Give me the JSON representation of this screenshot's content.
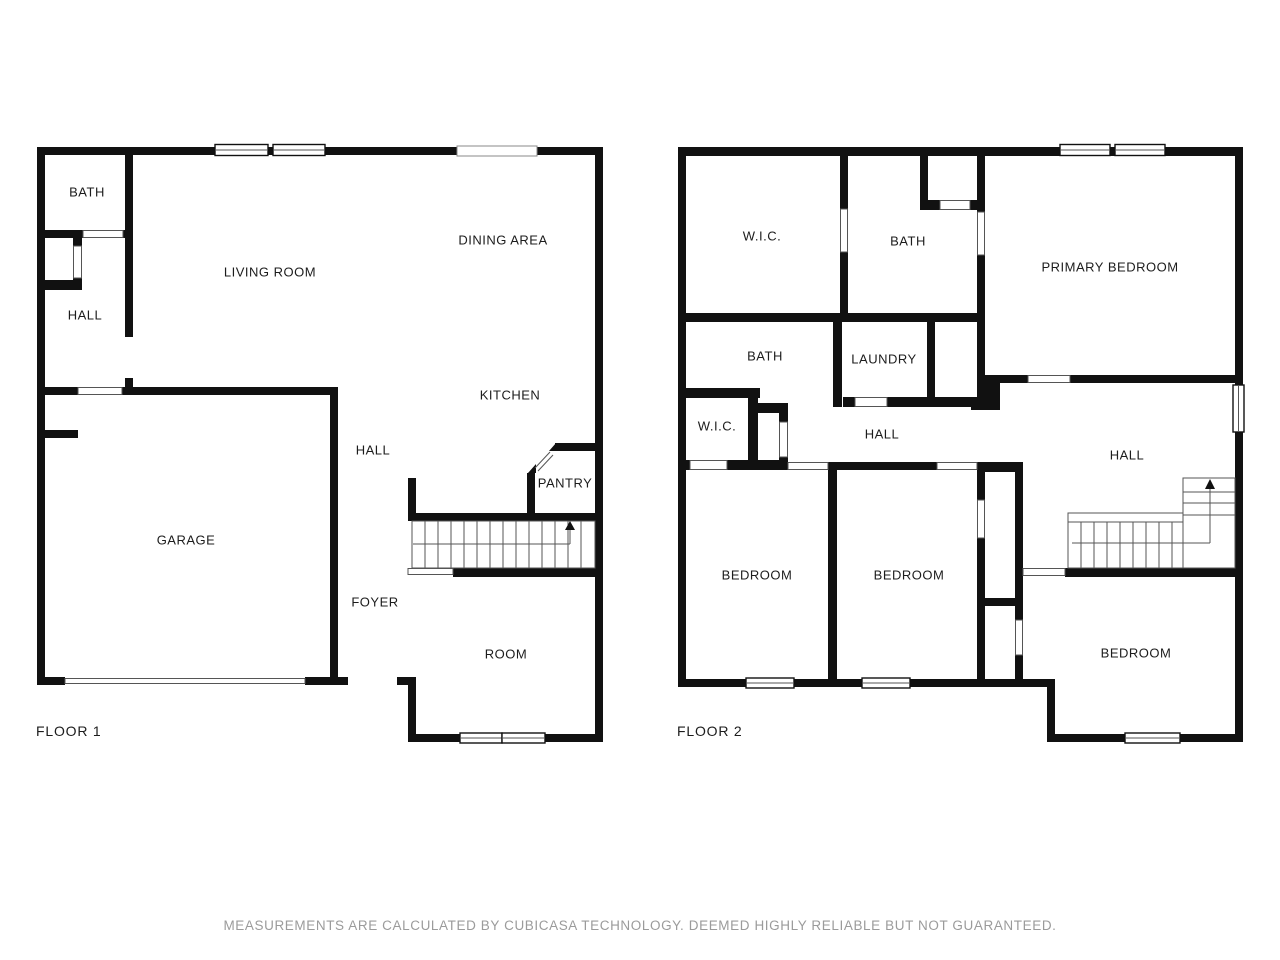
{
  "footer": {
    "disclaimer": "MEASUREMENTS ARE CALCULATED BY CUBICASA TECHNOLOGY. DEEMED HIGHLY RELIABLE BUT NOT GUARANTEED."
  },
  "floor1": {
    "title": "FLOOR 1",
    "rooms": [
      {
        "label": "BATH"
      },
      {
        "label": "LIVING ROOM"
      },
      {
        "label": "DINING AREA"
      },
      {
        "label": "HALL"
      },
      {
        "label": "KITCHEN"
      },
      {
        "label": "HALL"
      },
      {
        "label": "GARAGE"
      },
      {
        "label": "PANTRY"
      },
      {
        "label": "FOYER"
      },
      {
        "label": "ROOM"
      }
    ]
  },
  "floor2": {
    "title": "FLOOR 2",
    "rooms": [
      {
        "label": "W.I.C."
      },
      {
        "label": "BATH"
      },
      {
        "label": "PRIMARY BEDROOM"
      },
      {
        "label": "BATH"
      },
      {
        "label": "LAUNDRY"
      },
      {
        "label": "W.I.C."
      },
      {
        "label": "HALL"
      },
      {
        "label": "HALL"
      },
      {
        "label": "BEDROOM"
      },
      {
        "label": "BEDROOM"
      },
      {
        "label": "BEDROOM"
      }
    ]
  }
}
